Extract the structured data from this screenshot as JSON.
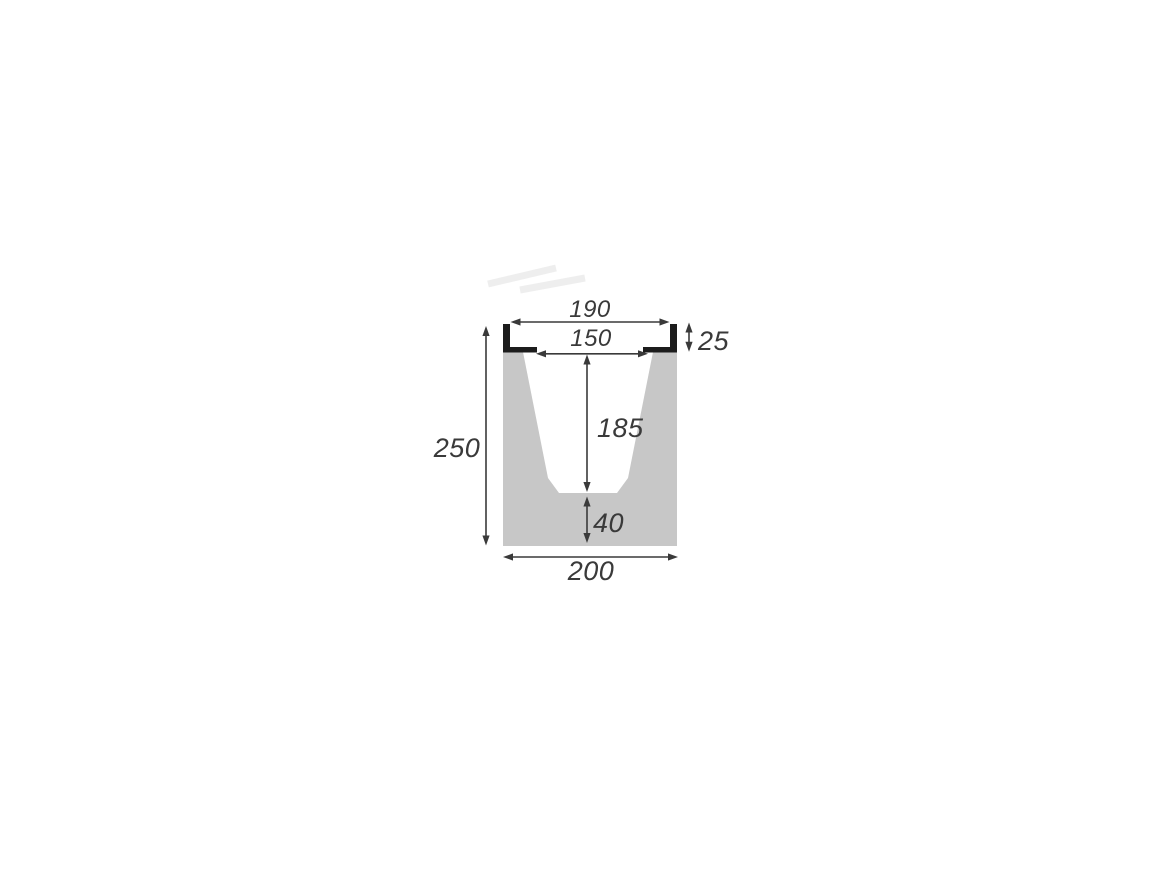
{
  "diagram": {
    "type": "channel-cross-section-drawing",
    "labels": {
      "top_opening_width": "190",
      "inner_top_width": "150",
      "rail_depth": "25",
      "total_height": "250",
      "channel_depth": "185",
      "base_thickness": "40",
      "bottom_width": "200"
    },
    "colors": {
      "concrete_fill": "#c7c7c7",
      "cavity_fill": "#ffffff",
      "rail_fill": "#1c1c1c",
      "dimension_color": "#3a3a3a",
      "background": "#ffffff"
    }
  }
}
